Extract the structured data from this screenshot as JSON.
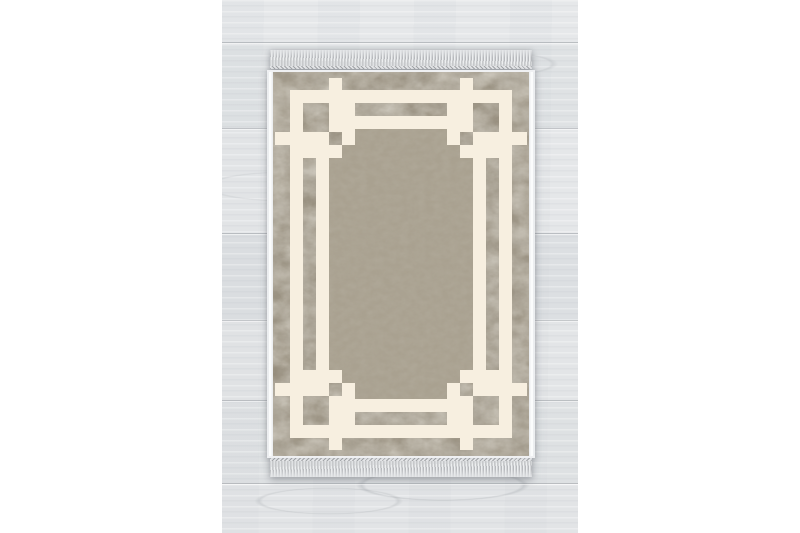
{
  "scene": {
    "type": "product-photo",
    "subject": "Rectangular area rug with an interlocking Greek key frame pattern and fringed ends, lying flat on a pale wood plank floor",
    "background": "white margins left and right of the photo"
  },
  "rug": {
    "orientation": "portrait",
    "parts": {
      "border": "mottled taupe outer border",
      "frame": "cream interlocking Greek key frame with corner knots",
      "field": "solid taupe center field with stepped corners",
      "fringe_top": "light gray tassel fringe",
      "fringe_bottom": "light gray tassel fringe",
      "selvedge": "white bound side edges"
    }
  },
  "palette": {
    "page_bg": "#ffffff",
    "wood_base": "#e2e4e6",
    "wood_line": "#b9bcc0",
    "border_taupe": "#948b7a",
    "border_taupe_dark": "#736b5c",
    "border_taupe_light": "#b8b09e",
    "cream": "#f7efe0",
    "field": "#a9a190",
    "selvedge": "#eceef0",
    "fringe_light": "#edeff0",
    "fringe_dark": "#b7b9bc",
    "shadow": "rgba(96,100,108,0.38)"
  }
}
